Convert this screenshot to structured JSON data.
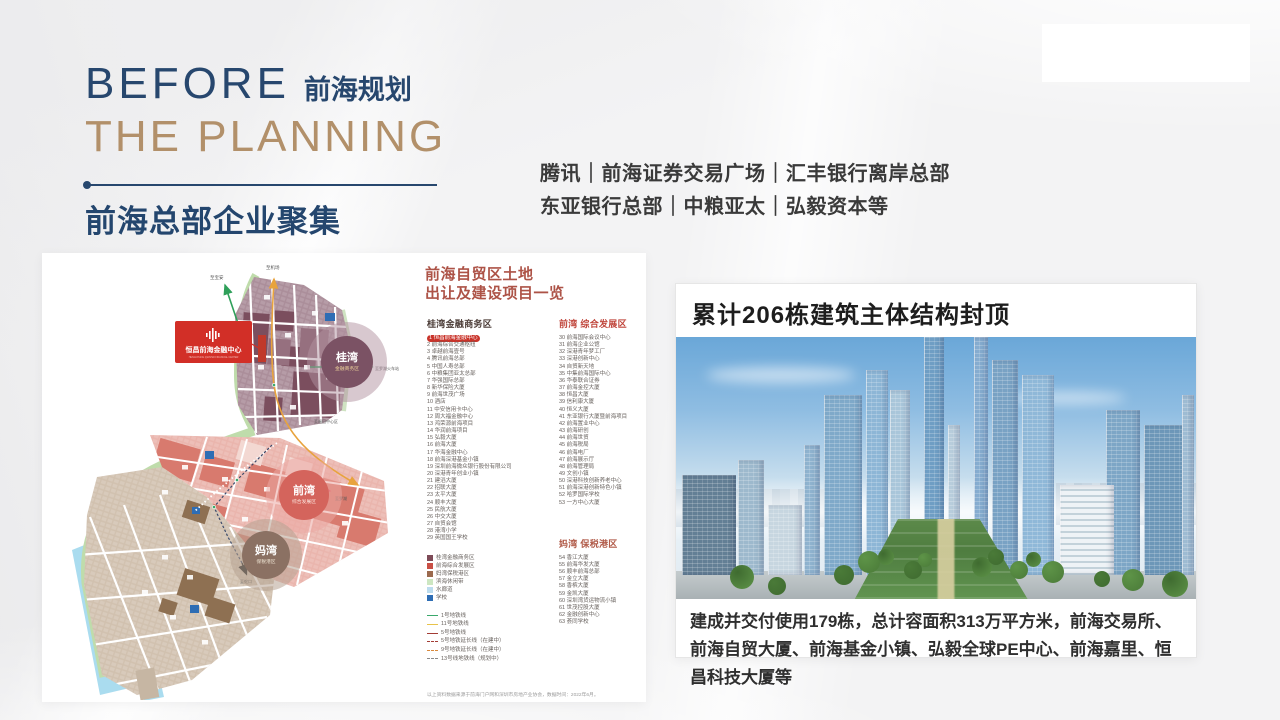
{
  "header": {
    "title_en_line1": "BEFORE",
    "title_cn_tag": "前海规划",
    "title_en_line2": "THE PLANNING",
    "subtitle_normal": "前海总部",
    "subtitle_bold": "企业聚集",
    "companies_line1": "腾讯｜前海证券交易广场｜汇丰银行离岸总部",
    "companies_line2": "东亚银行总部｜中粮亚太｜弘毅资本等"
  },
  "map": {
    "callout": {
      "name": "恒昌前海金融中心",
      "name_en": "HENGCHANG QIANHAI FINANCIAL CENTER"
    },
    "zones": [
      {
        "name": "桂湾",
        "sub": "金融商务区"
      },
      {
        "name": "前湾",
        "sub": "综合发展区"
      },
      {
        "name": "妈湾",
        "sub": "保税港区"
      }
    ],
    "direction_labels": {
      "top_left": "至宝安",
      "top": "至机场",
      "right": "至罗湖火车站",
      "mid_right": "至福田中心区",
      "luohu": "至罗湖",
      "shekou": "至蛇口"
    }
  },
  "project_list": {
    "title_line1": "前海自贸区土地",
    "title_line2": "出让及建设项目一览",
    "sections": [
      {
        "header": "桂湾金融商务区",
        "color": "#4a3b36",
        "items": [
          {
            "num": 1,
            "name": "恒昌前海金融中心",
            "highlight": true
          },
          {
            "num": 2,
            "name": "前海综合交通枢纽"
          },
          {
            "num": 3,
            "name": "卓越前海壹号"
          },
          {
            "num": 4,
            "name": "腾讯前海总部"
          },
          {
            "num": 5,
            "name": "中国人寿总部"
          },
          {
            "num": 6,
            "name": "中粮集团亚太总部"
          },
          {
            "num": 7,
            "name": "华强国际总部"
          },
          {
            "num": 8,
            "name": "新华保险大厦"
          },
          {
            "num": 9,
            "name": "前海世茂广场"
          },
          {
            "num": 10,
            "name": "酒店"
          },
          {
            "num": 11,
            "name": "中安信用卡中心"
          },
          {
            "num": 12,
            "name": "周大福金融中心"
          },
          {
            "num": 13,
            "name": "鸿荣源前海项目"
          },
          {
            "num": 14,
            "name": "华润前海项目"
          },
          {
            "num": 15,
            "name": "弘毅大厦"
          },
          {
            "num": 16,
            "name": "前海大厦"
          },
          {
            "num": 17,
            "name": "华海金融中心"
          },
          {
            "num": 18,
            "name": "前海深港基金小镇"
          },
          {
            "num": 19,
            "name": "深圳前海微众银行股份有限公司"
          },
          {
            "num": 20,
            "name": "深港青年创业小镇"
          },
          {
            "num": 21,
            "name": "建滔大厦"
          },
          {
            "num": 22,
            "name": "招联大厦"
          },
          {
            "num": 23,
            "name": "太平大厦"
          },
          {
            "num": 24,
            "name": "顺丰大厦"
          },
          {
            "num": 25,
            "name": "民航大厦"
          },
          {
            "num": 26,
            "name": "中交大厦"
          },
          {
            "num": 27,
            "name": "自贸会馆"
          },
          {
            "num": 28,
            "name": "港湾小学"
          },
          {
            "num": 29,
            "name": "英国国王学校"
          }
        ]
      },
      {
        "header": "前湾 综合发展区",
        "color": "#c0463c",
        "items": [
          {
            "num": 30,
            "name": "前海国际会议中心"
          },
          {
            "num": 31,
            "name": "前海企业公馆"
          },
          {
            "num": 32,
            "name": "深港青年梦工厂"
          },
          {
            "num": 33,
            "name": "深港创新中心"
          },
          {
            "num": 34,
            "name": "自贸新天地"
          },
          {
            "num": 35,
            "name": "中集前海国际中心"
          },
          {
            "num": 36,
            "name": "华泰联合证券"
          },
          {
            "num": 37,
            "name": "前海金控大厦"
          },
          {
            "num": 38,
            "name": "恒昌大厦"
          },
          {
            "num": 39,
            "name": "信利康大厦"
          },
          {
            "num": 40,
            "name": "恒义大厦"
          },
          {
            "num": 41,
            "name": "东亚银行大厦暨前海项目"
          },
          {
            "num": 42,
            "name": "前海置业中心"
          },
          {
            "num": 43,
            "name": "前海研创"
          },
          {
            "num": 44,
            "name": "前海世贸"
          },
          {
            "num": 45,
            "name": "前海税局"
          },
          {
            "num": 46,
            "name": "前海电厂"
          },
          {
            "num": 47,
            "name": "前海展示厅"
          },
          {
            "num": 48,
            "name": "前海管理局"
          },
          {
            "num": 49,
            "name": "文创小镇"
          },
          {
            "num": 50,
            "name": "深港科技创新养老中心"
          },
          {
            "num": 51,
            "name": "前海深港创新特色小镇"
          },
          {
            "num": 52,
            "name": "哈罗国际学校"
          },
          {
            "num": 53,
            "name": "一方中心大厦"
          }
        ]
      },
      {
        "header": "妈湾 保税港区",
        "color": "#b05a48",
        "items": [
          {
            "num": 54,
            "name": "香江大厦"
          },
          {
            "num": 55,
            "name": "前海华发大厦"
          },
          {
            "num": 56,
            "name": "顺丰前海总部"
          },
          {
            "num": 57,
            "name": "金立大厦"
          },
          {
            "num": 58,
            "name": "香槟大厦"
          },
          {
            "num": 59,
            "name": "金凯大厦"
          },
          {
            "num": 60,
            "name": "深圳湾货运物流小镇"
          },
          {
            "num": 61,
            "name": "世茂控股大厦"
          },
          {
            "num": 62,
            "name": "金融创新中心"
          },
          {
            "num": 63,
            "name": "荟同学校"
          }
        ]
      }
    ],
    "legend_zones": [
      {
        "color": "#7d4a57",
        "label": "桂湾金融商务区"
      },
      {
        "color": "#c94f45",
        "label": "前海综合发展区"
      },
      {
        "color": "#9b6a4e",
        "label": "妈湾保税港区"
      },
      {
        "color": "#cde7c2",
        "label": "滨海休闲带"
      },
      {
        "color": "#bcdcee",
        "label": "水廊道"
      },
      {
        "color": "#2e6db4",
        "label": "学校"
      }
    ],
    "legend_lines": [
      {
        "color": "#3aa86b",
        "dash": "solid",
        "label": "1号地铁线"
      },
      {
        "color": "#e8c34a",
        "dash": "solid",
        "label": "11号地铁线"
      },
      {
        "color": "#a33c35",
        "dash": "solid",
        "label": "5号地铁线"
      },
      {
        "color": "#a33c35",
        "dash": "dashed",
        "label": "5号地铁延长线（在建中）"
      },
      {
        "color": "#d98a3d",
        "dash": "dashed",
        "label": "9号地铁延长线（在建中）"
      },
      {
        "color": "#8a8a8a",
        "dash": "dashed",
        "label": "13号线地铁线（规划中）"
      }
    ],
    "footnote": "以上资料数据来源于前海门户网和深圳市房地产业协会，数据时间：2022年6月。"
  },
  "right_panel": {
    "headline": "累计206栋建筑主体结构封顶",
    "caption": "建成并交付使用179栋，总计容面积313万平方米，前海交易所、前海自贸大厦、前海基金小镇、弘毅全球PE中心、前海嘉里、恒昌科技大厦等"
  }
}
